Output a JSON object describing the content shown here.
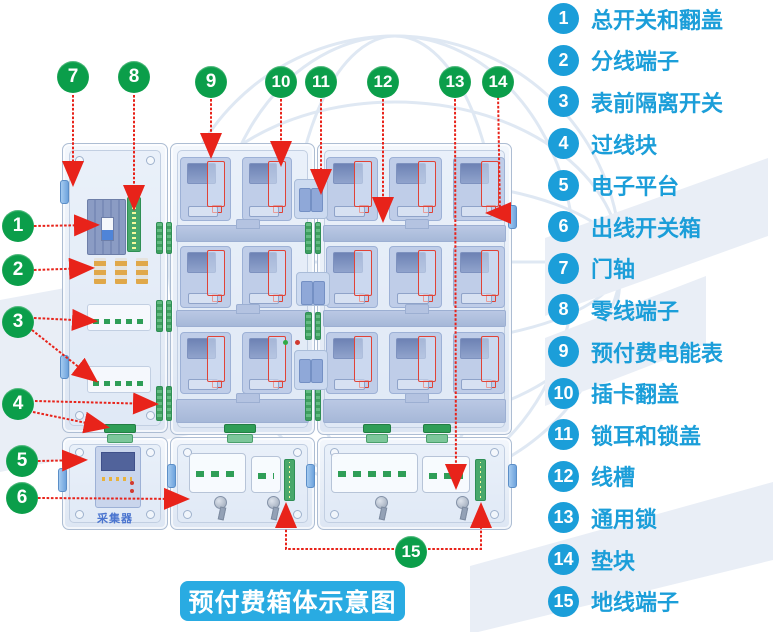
{
  "title_badge": {
    "text": "预付费箱体示意图"
  },
  "legend": {
    "items": [
      {
        "num": "1",
        "label": "总开关和翻盖"
      },
      {
        "num": "2",
        "label": "分线端子"
      },
      {
        "num": "3",
        "label": "表前隔离开关"
      },
      {
        "num": "4",
        "label": "过线块"
      },
      {
        "num": "5",
        "label": "电子平台"
      },
      {
        "num": "6",
        "label": "出线开关箱"
      },
      {
        "num": "7",
        "label": "门轴"
      },
      {
        "num": "8",
        "label": "零线端子"
      },
      {
        "num": "9",
        "label": "预付费电能表"
      },
      {
        "num": "10",
        "label": "插卡翻盖"
      },
      {
        "num": "11",
        "label": "锁耳和锁盖"
      },
      {
        "num": "12",
        "label": "线槽"
      },
      {
        "num": "13",
        "label": "通用锁"
      },
      {
        "num": "14",
        "label": "垫块"
      },
      {
        "num": "15",
        "label": "地线端子"
      }
    ]
  },
  "diagram": {
    "collector_label": "采集器"
  },
  "colors": {
    "legend_blue": "#1b9ed9",
    "title_bg": "#29abe2",
    "callout_green": "#0b9e4a",
    "arrow_red": "#e8231a",
    "panel_blue": "#dfe8f4",
    "meter_blue": "#bfcde8",
    "terminal_green": "#3f9e5f"
  }
}
